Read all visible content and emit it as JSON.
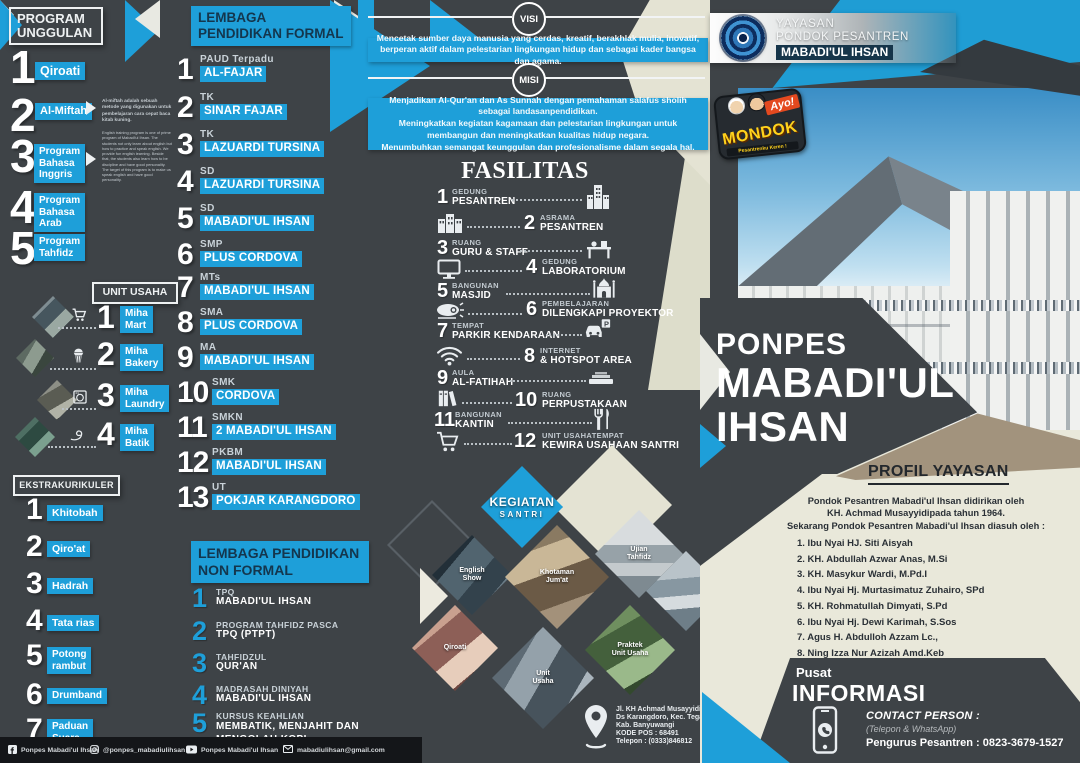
{
  "colors": {
    "background": "#3e4347",
    "accent_blue": "#1e9fd9",
    "cream": "#e9e8da",
    "tan": "#a2937d",
    "navy_text": "#14364d",
    "black_bar": "#141619"
  },
  "program_unggulan": {
    "title": "PROGRAM\nUNGGULAN",
    "items": [
      {
        "num": "1",
        "label": "Qiroati"
      },
      {
        "num": "2",
        "label": "Al-Miftah"
      },
      {
        "num": "3",
        "label": "Program\nBahasa\nInggris"
      },
      {
        "num": "4",
        "label": "Program\nBahasa\nArab"
      },
      {
        "num": "5",
        "label": "Program\nTahfidz"
      }
    ],
    "almiftah_note": "Al-miftah adalah sebuah metode yang digunakan untuk pembelajaran cara cepat baca kitab kuning.",
    "english_note": "English training program is one of prime program of Mabadi'ul Ihsan. The students not only learn about english but how to practice and speak english. We provide fun english learning. Beside that, the students also learn how to be discipline and have good personality. The target of this program is to make us speak english and have good personality."
  },
  "unit_usaha": {
    "title": "UNIT USAHA",
    "items": [
      {
        "num": "1",
        "label": "Miha\nMart",
        "icon": "cart-icon"
      },
      {
        "num": "2",
        "label": "Miha\nBakery",
        "icon": "cupcake-icon"
      },
      {
        "num": "3",
        "label": "Miha\nLaundry",
        "icon": "washer-icon"
      },
      {
        "num": "4",
        "label": "Miha\nBatik",
        "icon": "canting-icon"
      }
    ]
  },
  "ekstrakurikuler": {
    "title": "EKSTRAKURIKULER",
    "items": [
      {
        "num": "1",
        "label": "Khitobah"
      },
      {
        "num": "2",
        "label": "Qiro'at"
      },
      {
        "num": "3",
        "label": "Hadrah"
      },
      {
        "num": "4",
        "label": "Tata rias"
      },
      {
        "num": "5",
        "label": "Potong\nrambut"
      },
      {
        "num": "6",
        "label": "Drumband"
      },
      {
        "num": "7",
        "label": "Paduan\nSuara"
      }
    ]
  },
  "formal": {
    "title": "LEMBAGA\nPENDIDIKAN FORMAL",
    "items": [
      {
        "num": "1",
        "type": "PAUD Terpadu",
        "name": "AL-FAJAR"
      },
      {
        "num": "2",
        "type": "TK",
        "name": "SINAR FAJAR"
      },
      {
        "num": "3",
        "type": "TK",
        "name": "LAZUARDI TURSINA"
      },
      {
        "num": "4",
        "type": "SD",
        "name": "LAZUARDI TURSINA"
      },
      {
        "num": "5",
        "type": "SD",
        "name": "MABADI'UL IHSAN"
      },
      {
        "num": "6",
        "type": "SMP",
        "name": "PLUS CORDOVA"
      },
      {
        "num": "7",
        "type": "MTs",
        "name": "MABADI'UL IHSAN"
      },
      {
        "num": "8",
        "type": "SMA",
        "name": "PLUS CORDOVA"
      },
      {
        "num": "9",
        "type": "MA",
        "name": "MABADI'UL IHSAN"
      },
      {
        "num": "10",
        "type": "SMK",
        "name": "CORDOVA"
      },
      {
        "num": "11",
        "type": "SMKN",
        "name": "2 MABADI'UL IHSAN"
      },
      {
        "num": "12",
        "type": "PKBM",
        "name": "MABADI'UL IHSAN"
      },
      {
        "num": "13",
        "type": "UT",
        "name": "POKJAR KARANGDORO"
      }
    ]
  },
  "nonformal": {
    "title": "LEMBAGA PENDIDIKAN\nNON FORMAL",
    "items": [
      {
        "num": "1",
        "type": "TPQ",
        "name": "MABADI'UL IHSAN"
      },
      {
        "num": "2",
        "type": "PROGRAM TAHFIDZ PASCA",
        "name": "TPQ (PTPT)"
      },
      {
        "num": "3",
        "type": "TAHFIDZUL",
        "name": "QUR'AN"
      },
      {
        "num": "4",
        "type": "MADRASAH DINIYAH",
        "name": "MABADI'UL IHSAN"
      },
      {
        "num": "5",
        "type": "KURSUS KEAHLIAN",
        "name": "MEMBATIK, MENJAHIT DAN\nMENGOLAH KOPI"
      }
    ]
  },
  "visi": {
    "label": "VISI",
    "text": "Mencetak sumber daya manusia yang cerdas, kreatif, berakhlak mulia, inovatif, berperan aktif dalam pelestarian lingkungan hidup dan sebagai kader bangsa dan agama."
  },
  "misi": {
    "label": "MISI",
    "items": [
      "Menjadikan Al-Qur'an dan As Sunnah dengan pemahaman salafus sholih sebagai landasanpendidikan.",
      "Meningkatkan kegiatan kagamaan dan pelestarian lingkungan untuk membangun dan meningkatkan kualitas hidup negara.",
      "Menumbuhkan semangat keunggulan dan profesionalisme dalam segala hal."
    ]
  },
  "fasilitas": {
    "title": "FASILITAS",
    "items": [
      {
        "num": "1",
        "line1": "GEDUNG",
        "line2": "PESANTREN",
        "icon": "building-icon"
      },
      {
        "num": "2",
        "line1": "ASRAMA",
        "line2": "PESANTREN",
        "icon": "dorm-icon"
      },
      {
        "num": "3",
        "line1": "RUANG",
        "line2": "GURU & STAFF",
        "icon": "desk-icon"
      },
      {
        "num": "4",
        "line1": "GEDUNG",
        "line2": "LABORATORIUM",
        "icon": "monitor-icon"
      },
      {
        "num": "5",
        "line1": "BANGUNAN",
        "line2": "MASJID",
        "icon": "mosque-icon"
      },
      {
        "num": "6",
        "line1": "PEMBELAJARAN",
        "line2": "DILENGKAPI PROYEKTOR",
        "icon": "projector-icon"
      },
      {
        "num": "7",
        "line1": "TEMPAT",
        "line2": "PARKIR KENDARAAN",
        "icon": "car-parking-icon"
      },
      {
        "num": "8",
        "line1": "INTERNET",
        "line2": "& HOTSPOT AREA",
        "icon": "wifi-icon"
      },
      {
        "num": "9",
        "line1": "AULA",
        "line2": "AL-FATIHAH",
        "icon": "stage-icon"
      },
      {
        "num": "10",
        "line1": "RUANG",
        "line2": "PERPUSTAKAAN",
        "icon": "books-icon"
      },
      {
        "num": "11",
        "line1": "BANGUNAN",
        "line2": "KANTIN",
        "icon": "utensils-icon"
      },
      {
        "num": "12",
        "line1": "UNIT USAHATEMPAT",
        "line2": "KEWIRA USAHAAN SANTRI",
        "icon": "cart-icon"
      }
    ]
  },
  "kegiatan": {
    "title": "KEGIATAN",
    "subtitle": "SANTRI",
    "photos": [
      {
        "label": "English\nShow"
      },
      {
        "label": "Khotaman\nJum'at"
      },
      {
        "label": "Ujian\nTahfidz"
      },
      {
        "label": ""
      },
      {
        "label": "Qiroati"
      },
      {
        "label": "Unit\nUsaha"
      },
      {
        "label": "Praktek\nUnit Usaha"
      }
    ]
  },
  "yayasan": {
    "line1": "YAYASAN",
    "line2": "PONDOK PESANTREN",
    "line3": "MABADI'UL IHSAN"
  },
  "ayo_mondok": {
    "tag": "Ayo!",
    "name": "MONDOK",
    "tagline": "Pesantrenku Keren !"
  },
  "ponpes": {
    "line1": "PONPES",
    "line2": "MABADI'UL",
    "line3": "IHSAN"
  },
  "profil": {
    "title": "PROFIL YAYASAN",
    "intro": [
      "Pondok Pesantren Mabadi'ul Ihsan didirikan oleh",
      "KH. Achmad Musayyidipada tahun 1964.",
      "Sekarang Pondok Pesantren Mabadi'ul Ihsan diasuh oleh :"
    ],
    "names": [
      "1. Ibu Nyai HJ. Siti Aisyah",
      "2. KH. Abdullah Azwar Anas, M.Si",
      "3. KH. Masykur Wardi, M.Pd.I",
      "4. Ibu Nyai Hj. Murtasimatuz Zuhairo, SPd",
      "5. KH. Rohmatullah Dimyati, S.Pd",
      "6. Ibu Nyai Hj. Dewi Karimah, S.Sos",
      "7. Agus H. Abdulloh Azzam Lc.,",
      "8. Ning Izza Nur Azizah Amd.Keb"
    ]
  },
  "informasi": {
    "line1": "Pusat",
    "line2": "INFORMASI",
    "contact_label": "CONTACT PERSON :",
    "contact_sub": "(Telepon & WhatsApp)",
    "contact_value": "Pengurus Pesantren : 0823-3679-1527"
  },
  "address": {
    "lines": [
      "Jl. KH Achmad Musayyidi",
      "Ds Karangdoro, Kec. Tegalsari",
      "Kab. Banyuwangi",
      "KODE POS : 68491",
      "Telepon : (0333)846812"
    ]
  },
  "footer": {
    "facebook": "Ponpes Mabadi'ul Ihsan",
    "instagram": "@ponpes_mabadiulihsan",
    "youtube": "Ponpes Mabadi'ul Ihsan",
    "email": "mabadiulihsan@gmail.com"
  }
}
